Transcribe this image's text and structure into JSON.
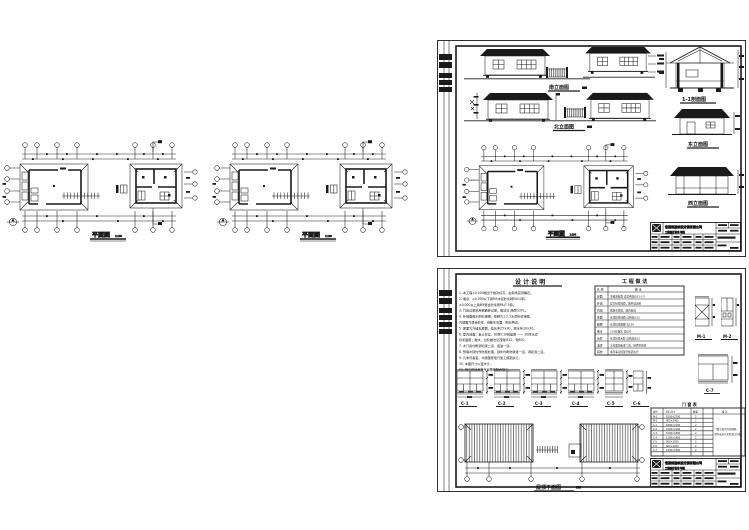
{
  "labels": {
    "plan": "平面图",
    "scale": "1:100"
  },
  "sheet1": {
    "elev_south": "南立面图",
    "elev_north": "北立面图",
    "section": "1-1剖面图",
    "elev_east": "东立面图",
    "elev_west": "西立面图"
  },
  "sheet2": {
    "notes_title": "设 计 说 明",
    "notes": [
      "1. 本工程±0.000相当于绝对标高，由现场实测确定。",
      "2. 墙身：±0.000以下用M5水泥砂浆砌MU10砖，",
      "      ±0.000以上用M5混合砂浆砌MU7.5砖。",
      "3. 门窗过梁采用钢筋砖过梁，做法见 西南G301。",
      "4. 外墙面做水刷石墙裙，勒脚为1:2.5水泥砂浆抹面，",
      "      内墙面为混合砂浆，纸筋灰罩面，刷白两道。",
      "5. 屋面为冷摊瓦屋面，挂瓦条25×30，顺水条30×30。",
      "6. 室内地面：素土夯实，80厚C10砼垫层 —— 20厚水泥",
      "      砂浆面层；散水、台阶做法见西南J812，宽600。",
      "7. 木门窗均刷调和漆二道，底油一道。",
      "8. 预埋木砖均作防腐处理，铁件均刷防锈漆一道，调和漆二道。",
      "9. 凡未尽事宜，均按国家现行施工规范执行。",
      "10. 本图尺寸以毫米计。",
      "11. 施工时请与各专业图纸配合施工。"
    ],
    "practice": {
      "title": "工 程 做 法",
      "col1": "名 称",
      "col2": "做  法",
      "rows": [
        {
          "name": "屋面",
          "desc": "冷摊瓦屋面  详见西南J201-1-2"
        },
        {
          "name": "外墙",
          "desc": "混合砂浆抹面，刷外墙涂料"
        },
        {
          "name": "内墙",
          "desc": "纸筋灰罩面，刷白两道"
        },
        {
          "name": "地面",
          "desc": "水泥砂浆地面  详西南J312"
        },
        {
          "name": "踢脚",
          "desc": "水泥砂浆踢脚  高150"
        },
        {
          "name": "散水",
          "desc": "C10砼散水  宽600"
        },
        {
          "name": "台阶",
          "desc": "水泥砂浆台阶  详西南J812"
        },
        {
          "name": "油漆",
          "desc": "木材面调和漆二道，铁件防锈漆"
        },
        {
          "name": "其他",
          "desc": "未尽事宜按现行规范执行"
        }
      ]
    },
    "windows": {
      "c1": "C-1",
      "c2": "C-2",
      "c3": "C-3",
      "c4": "C-4",
      "c5": "C-5",
      "c6": "C-6",
      "c7": "C-7",
      "m1": "M-1",
      "m2": "M-2"
    },
    "schedule": {
      "title": "门 窗 表",
      "headers": [
        "编号",
        "洞口尺寸",
        "数量",
        "备 注"
      ],
      "rows": [
        {
          "code": "M-1",
          "size": "1000×2700",
          "qty": "2"
        },
        {
          "code": "M-2",
          "size": "900×2400",
          "qty": "2"
        },
        {
          "code": "C-1",
          "size": "1800×2100",
          "qty": "2"
        },
        {
          "code": "C-2",
          "size": "1500×2100",
          "qty": "2"
        },
        {
          "code": "C-3",
          "size": "1500×1800",
          "qty": "2"
        },
        {
          "code": "C-4",
          "size": "1200×1800",
          "qty": "2"
        },
        {
          "code": "C-5",
          "size": "900×1500",
          "qty": "2"
        },
        {
          "code": "C-6",
          "size": "600×1200",
          "qty": "2"
        },
        {
          "code": "C-7",
          "size": "1500×1500",
          "qty": "2"
        }
      ],
      "remark1": "门窗立面均为外视图，",
      "remark2": "制作安装以实际洞口为准。"
    },
    "roof_label": "屋顶平面图"
  },
  "titleblock": {
    "company": "省建筑勘察设计院有限公司",
    "cert": "工程设计证书 甲级"
  }
}
